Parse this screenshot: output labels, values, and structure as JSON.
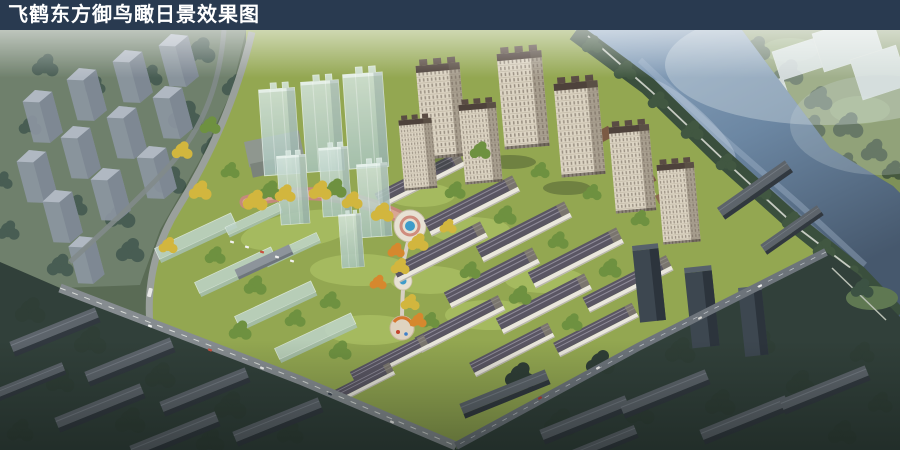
{
  "title_bar": {
    "title": "飞鹤东方御鸟瞰日景效果图"
  },
  "scene": {
    "type": "aerial-architectural-rendering",
    "subject": "bird's-eye daytime rendering of a riverside residential development",
    "regions": [
      "context-city-blocks-left",
      "river",
      "far-bank-greenway",
      "ghost-massing-blocks",
      "development-site",
      "glass-massing-towers",
      "residential-towers",
      "midrise-slab-rows",
      "central-promenade",
      "fountain-plaza",
      "playground",
      "boundary-roads",
      "dark-context-neighborhoods"
    ],
    "palette": {
      "bar_bg": "#293a50",
      "bar_text": "#ffffff",
      "water": "#6c87a3",
      "site_grass": "#93a751",
      "autumn_tree": "#d2b63e",
      "orange_tree": "#d6882e",
      "tower_facade": "#ddd5c4",
      "ghost_glass": "#c8dcd4",
      "context_dark": "#31403a",
      "road": "#8e9492",
      "promenade": "#c5897c",
      "pool": "#3f9cc9",
      "haze": "#dfe7ec"
    }
  }
}
